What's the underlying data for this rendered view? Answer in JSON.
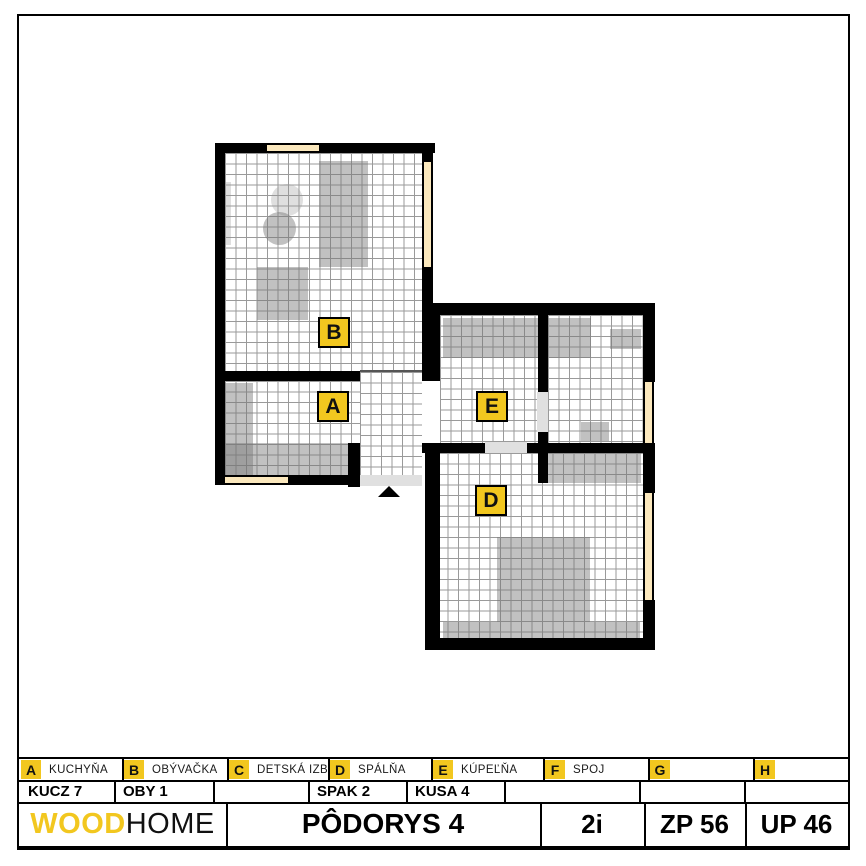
{
  "plan": {
    "labels": {
      "a": "A",
      "b": "B",
      "d": "D",
      "e": "E"
    },
    "rooms_shown": [
      "A",
      "B",
      "D",
      "E"
    ]
  },
  "legend": {
    "items": [
      {
        "key": "A",
        "label": "KUCHYŇA"
      },
      {
        "key": "B",
        "label": "OBÝVAČKA"
      },
      {
        "key": "C",
        "label": "DETSKÁ IZBA"
      },
      {
        "key": "D",
        "label": "SPÁLŇA"
      },
      {
        "key": "E",
        "label": "KÚPEĽŇA"
      },
      {
        "key": "F",
        "label": "SPOJ"
      },
      {
        "key": "G",
        "label": ""
      },
      {
        "key": "H",
        "label": ""
      }
    ],
    "codes": [
      "KUCZ 7",
      "OBY 1",
      "",
      "SPAK 2",
      "KUSA 4",
      "",
      "",
      ""
    ]
  },
  "titlebar": {
    "brand_wood": "WOOD",
    "brand_home": "HOME",
    "title": "PÔDORYS 4",
    "layout": "2i",
    "zp": "ZP 56",
    "up": "UP 46"
  },
  "colors": {
    "accent_yellow": "#F2C71F",
    "window_cream": "#FBE8BD",
    "wall_black": "#000000",
    "furniture_gray": "#BDBDBD",
    "door_gray": "#E0E0E0"
  }
}
